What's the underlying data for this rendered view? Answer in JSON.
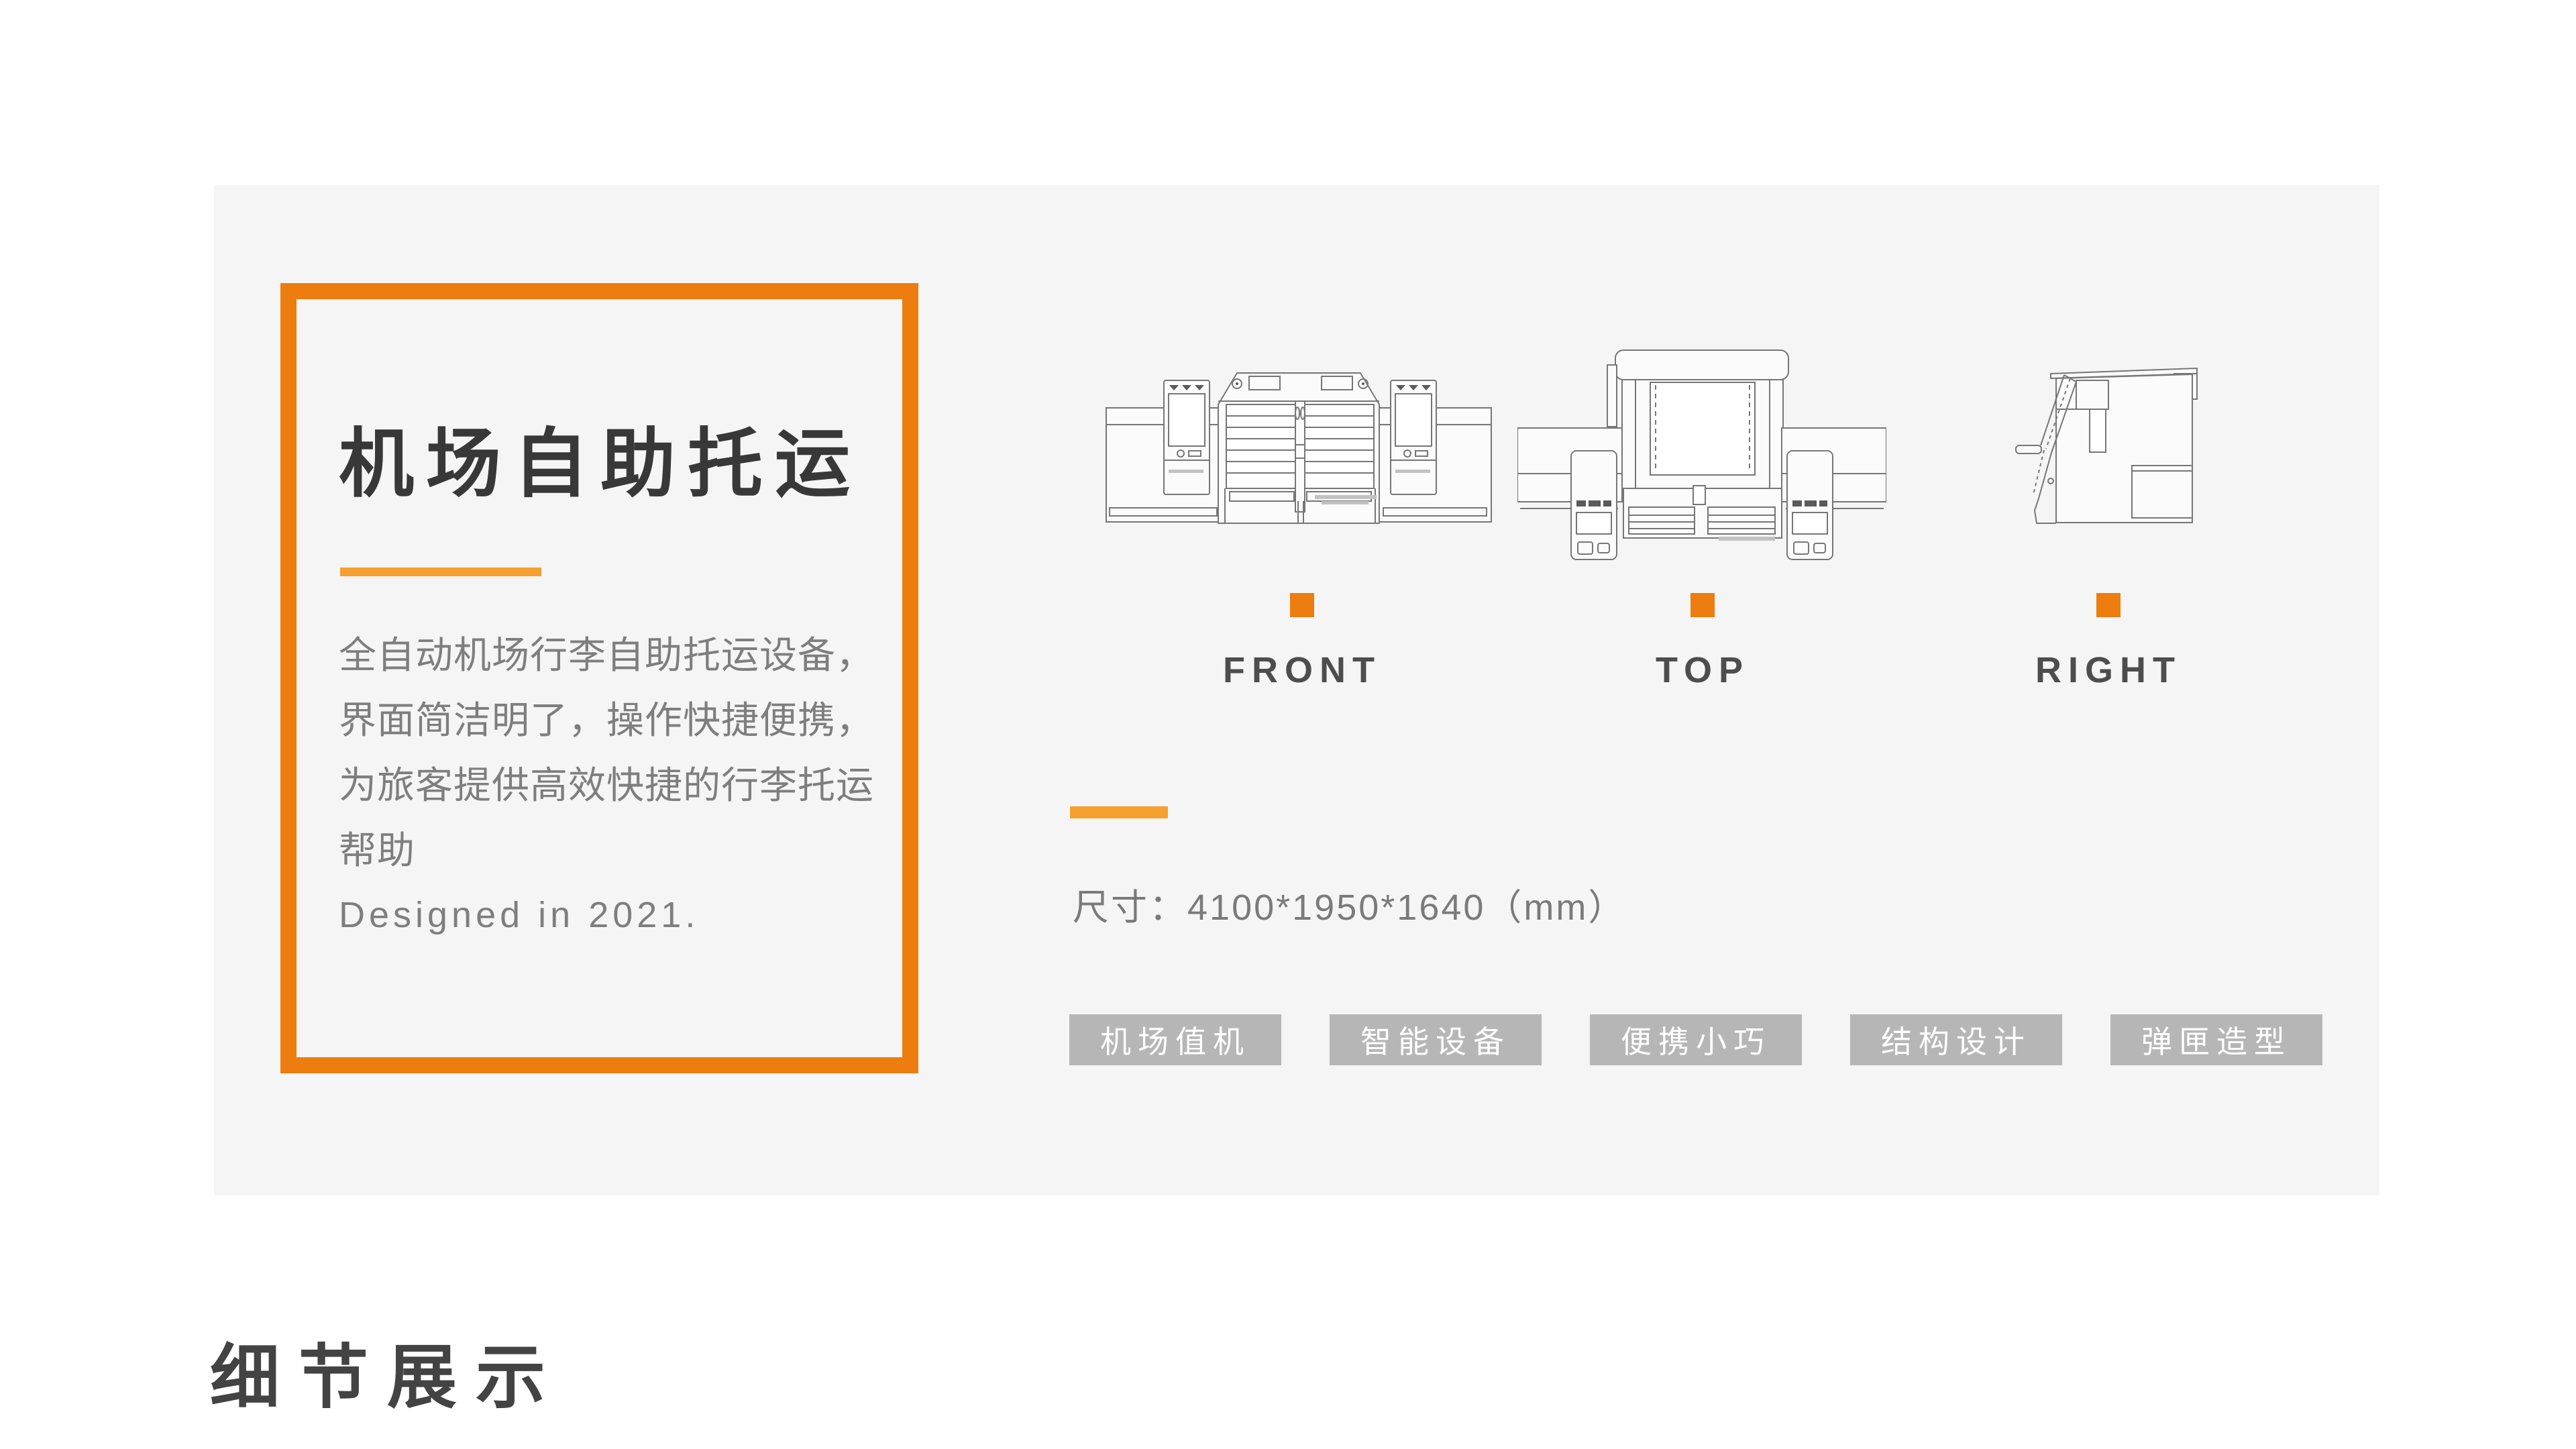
{
  "colors": {
    "accent_orange": "#ED7D0E",
    "accent_light_orange": "#F6A02F",
    "panel_background": "#F5F5F5",
    "tag_background": "#B6B6B6",
    "tag_text": "#FFFFFF"
  },
  "info_card": {
    "title": "机场自助托运",
    "description_lines": [
      "全自动机场行李自助托运设备，",
      "界面简洁明了，操作快捷便携，",
      "为旅客提供高效快捷的行李托运",
      "帮助"
    ],
    "designed_note": "Designed in 2021."
  },
  "views": [
    {
      "label": "FRONT"
    },
    {
      "label": "TOP"
    },
    {
      "label": "RIGHT"
    }
  ],
  "spec": {
    "dimensions": "尺寸：4100*1950*1640（mm）"
  },
  "tags": [
    "机场值机",
    "智能设备",
    "便携小巧",
    "结构设计",
    "弹匣造型"
  ],
  "section": {
    "heading": "细节展示"
  }
}
